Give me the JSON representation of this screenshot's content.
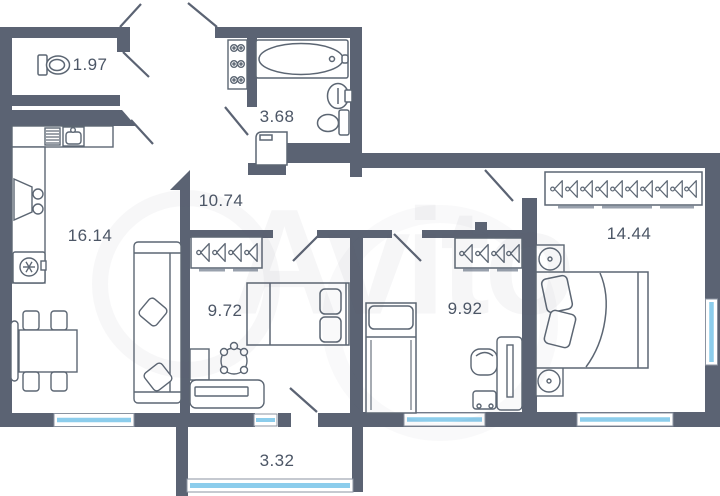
{
  "app": {
    "watermark_text": "Avito"
  },
  "colors": {
    "wall": "#5b6373",
    "window_glass": "#8ccdec",
    "furniture_line": "#5c6673",
    "label_text": "#4c5666",
    "wardrobe_foot": "#99a1ad"
  },
  "rooms": [
    {
      "key": "wc",
      "area_label": "1.97"
    },
    {
      "key": "bathroom",
      "area_label": "3.68"
    },
    {
      "key": "hallway",
      "area_label": "10.74"
    },
    {
      "key": "kitchen-living",
      "area_label": "16.14"
    },
    {
      "key": "bedroom-1",
      "area_label": "9.72"
    },
    {
      "key": "bedroom-2",
      "area_label": "9.92"
    },
    {
      "key": "bedroom-3",
      "area_label": "14.44"
    },
    {
      "key": "balcony",
      "area_label": "3.32"
    }
  ],
  "icons": [
    "toilet-icon",
    "bathtub-icon",
    "washbasin-icon",
    "washing-machine-icon",
    "shoe-shelf-icon",
    "kitchen-sink-icon",
    "dish-drainer-icon",
    "stove-icon",
    "fridge-icon",
    "dining-table-icon",
    "chair-icon",
    "sofa-icon",
    "wardrobe-hangers-icon",
    "bed-icon",
    "desk-icon",
    "office-chair-icon",
    "nightstand-icon",
    "window-icon",
    "door-swing-icon"
  ]
}
